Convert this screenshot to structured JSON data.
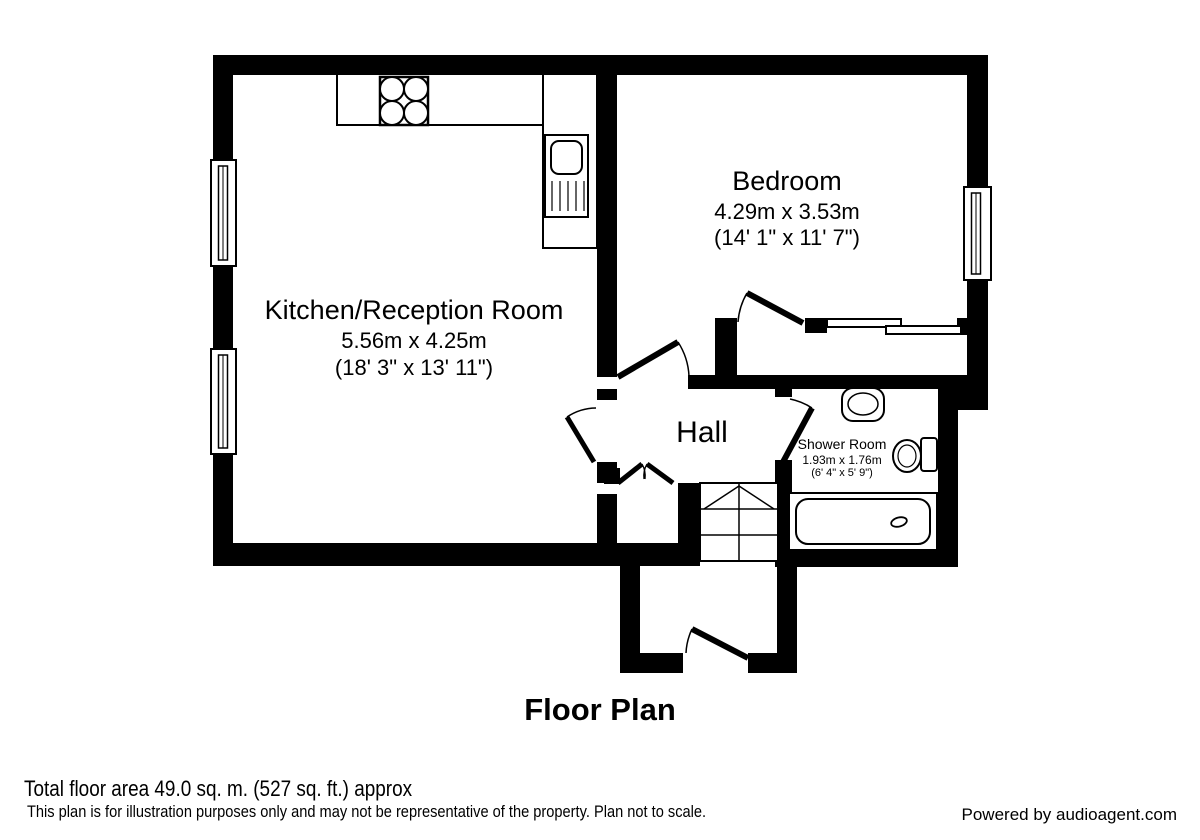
{
  "title": "Floor Plan",
  "rooms": {
    "kitchen": {
      "name": "Kitchen/Reception Room",
      "metric": "5.56m x 4.25m",
      "imperial": "(18' 3\" x 13' 11\")"
    },
    "bedroom": {
      "name": "Bedroom",
      "metric": "4.29m x 3.53m",
      "imperial": "(14' 1\" x 11' 7\")"
    },
    "hall": {
      "name": "Hall"
    },
    "shower_room": {
      "name": "Shower Room",
      "metric": "1.93m x 1.76m",
      "imperial": "(6' 4\" x 5' 9\")"
    }
  },
  "footer": {
    "total_area": "Total floor area 49.0 sq. m. (527 sq. ft.) approx",
    "disclaimer": "This plan is for illustration purposes only and may not be representative of the property. Plan not to scale.",
    "credit": "Powered by audioagent.com"
  },
  "colors": {
    "wall": "#000000",
    "background": "#ffffff"
  }
}
